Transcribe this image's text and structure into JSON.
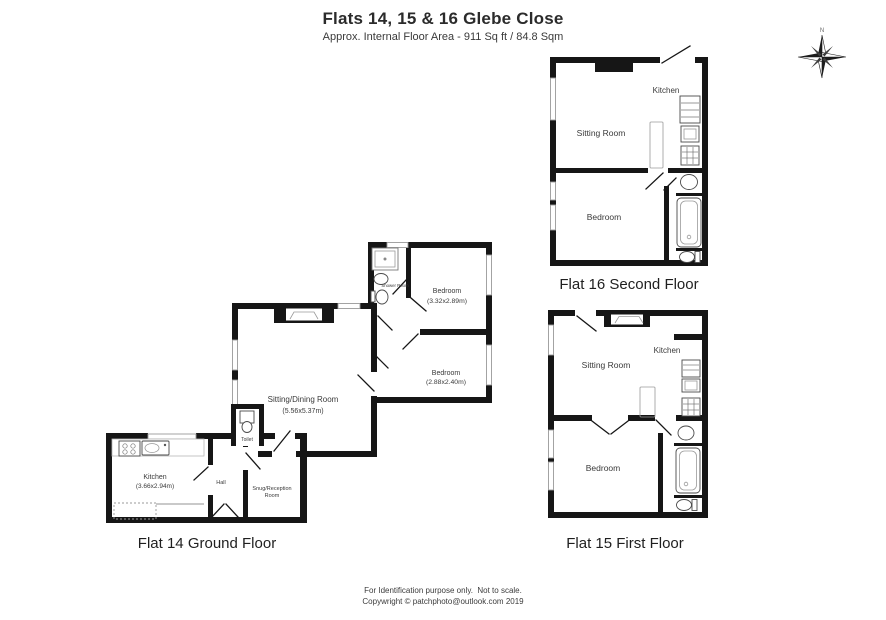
{
  "header": {
    "title": "Flats 14, 15 & 16 Glebe Close",
    "subtitle": "Approx. Internal Floor Area - 911 Sq ft / 84.8 Sqm"
  },
  "compass": {
    "north": "N"
  },
  "flat14": {
    "title": "Flat 14 Ground Floor",
    "kitchen": {
      "name": "Kitchen",
      "dims": "(3.66x2.94m)"
    },
    "hall": {
      "name": "Hall"
    },
    "snug": {
      "line1": "Snug/Reception",
      "line2": "Room"
    },
    "toilet": {
      "name": "Toilet"
    },
    "sitting": {
      "name": "Sitting/Dining Room",
      "dims": "(5.56x5.37m)"
    },
    "shower": {
      "name": "Shower Room"
    },
    "bedroom1": {
      "name": "Bedroom",
      "dims": "(3.32x2.89m)"
    },
    "bedroom2": {
      "name": "Bedroom",
      "dims": "(2.88x2.40m)"
    }
  },
  "flat15": {
    "title": "Flat 15 First Floor",
    "kitchen": "Kitchen",
    "sitting": "Sitting Room",
    "bedroom": "Bedroom"
  },
  "flat16": {
    "title": "Flat 16 Second Floor",
    "kitchen": "Kitchen",
    "sitting": "Sitting Room",
    "bedroom": "Bedroom"
  },
  "footer": {
    "line1": "For Identification purpose only.  Not to scale.",
    "line2": "Copywright © patchphoto@outlook.com 2019"
  },
  "colors": {
    "wall": "#161616",
    "window_frame": "#9a9a9a",
    "fixture": "#4a4a4a"
  }
}
